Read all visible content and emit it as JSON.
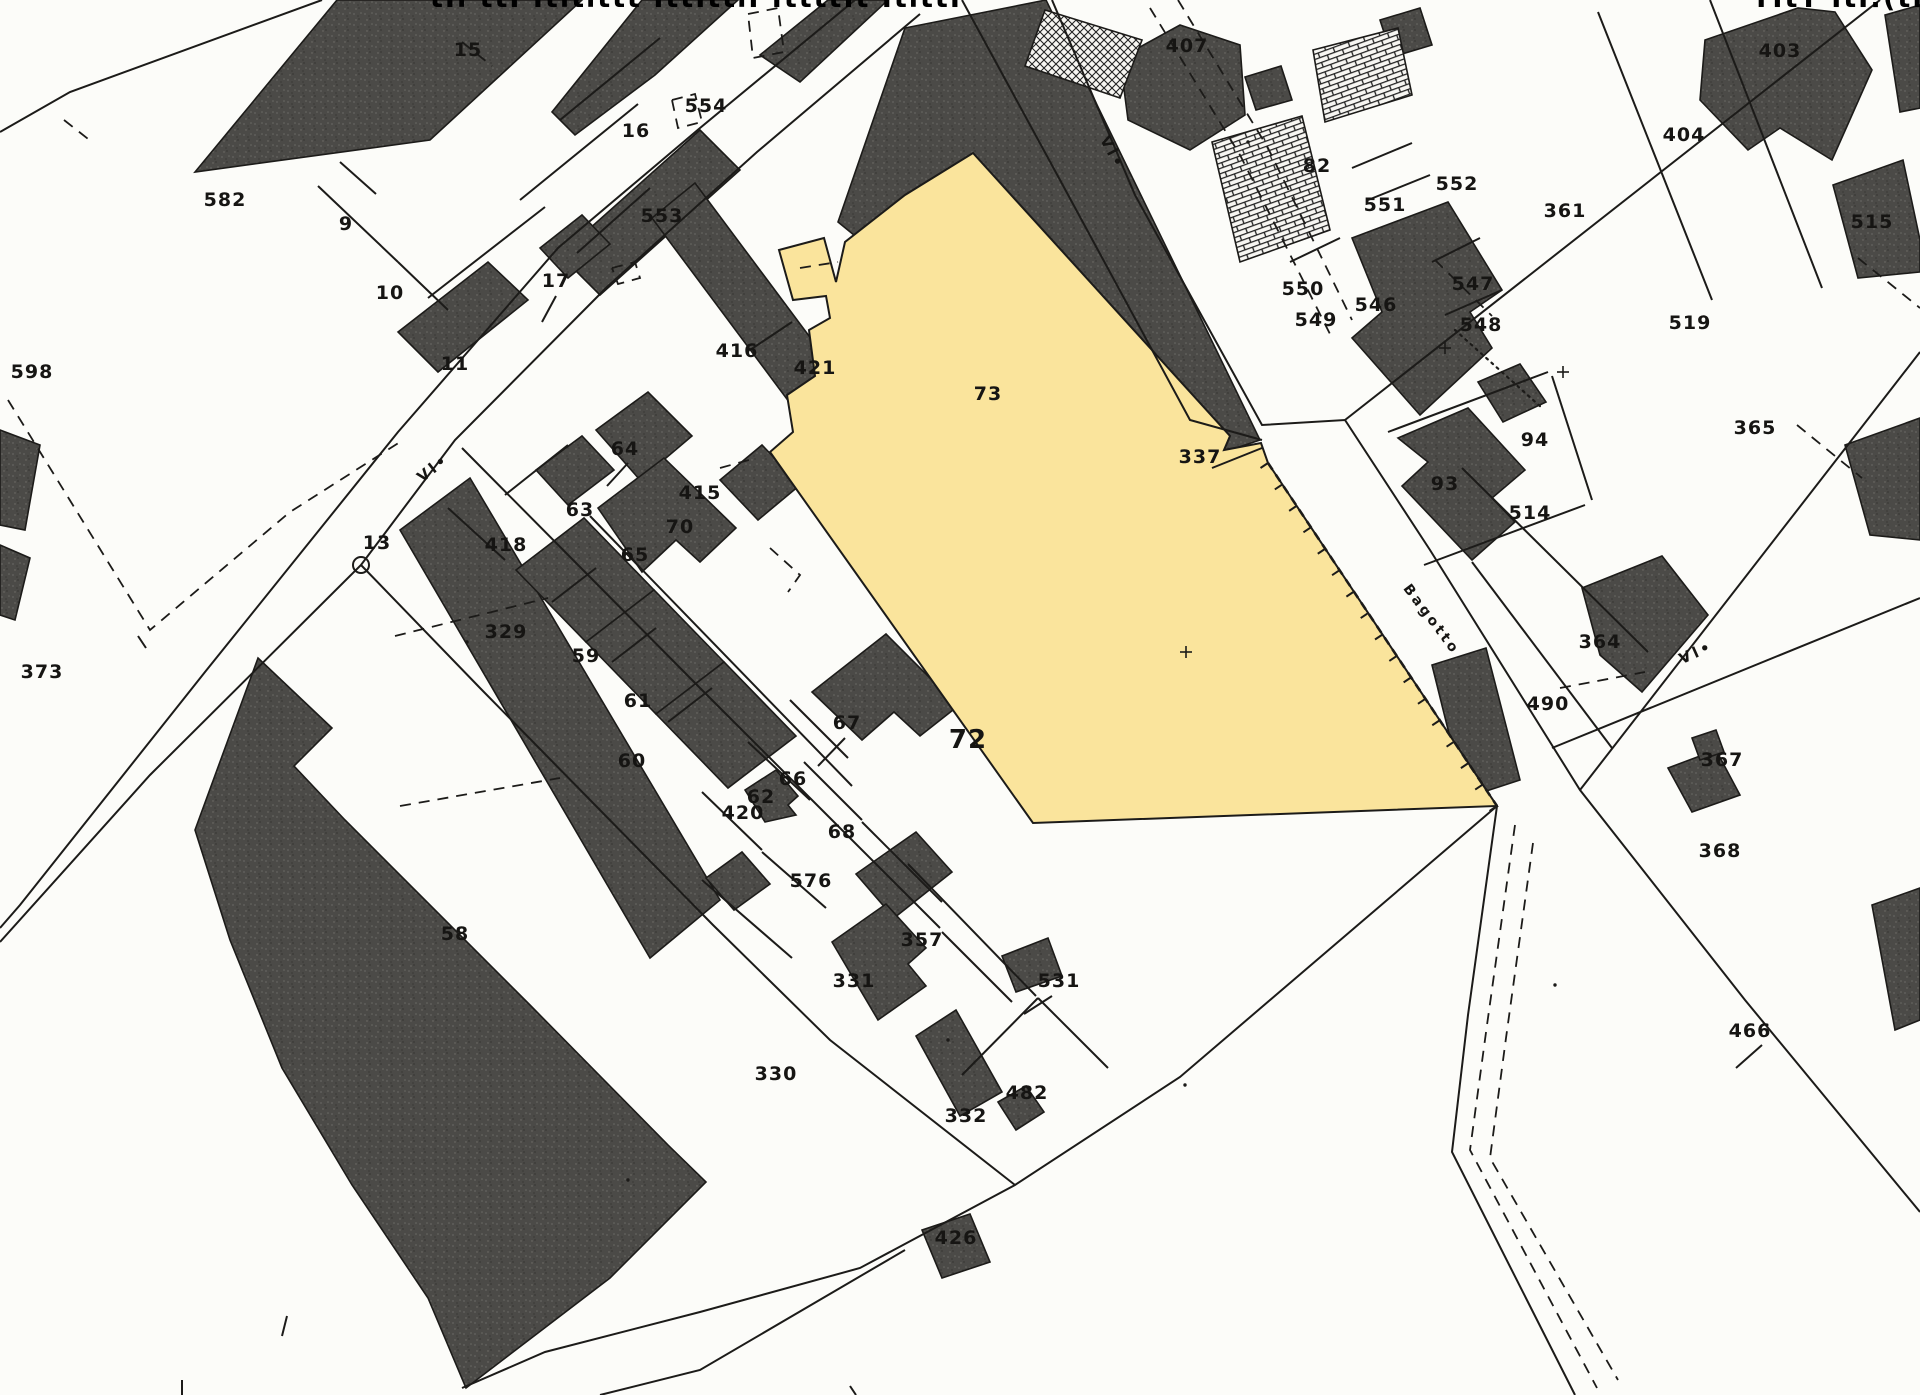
{
  "map": {
    "type": "cadastral-parcel-map",
    "background_color": "#fcfcf9",
    "line_color": "#1c1b19",
    "building_fill": "#4b4a47",
    "highlight": {
      "parcel_number": "73",
      "fill_color": "#fae49c"
    },
    "top_strip": {
      "left_fragment": "tIl ttI Itltlttt   IttIttlI IttttIt ItlttI",
      "right_fragment": "TItT ItI:(tIII It"
    },
    "street_labels": [
      {
        "text": "Vl•",
        "x": 436,
        "y": 472,
        "rot": -38,
        "size": 15
      },
      {
        "text": "Vl•",
        "x": 1108,
        "y": 155,
        "rot": 62,
        "size": 15
      },
      {
        "text": "Vl•",
        "x": 1698,
        "y": 657,
        "rot": -24,
        "size": 15
      },
      {
        "text": "Bagotto",
        "x": 1428,
        "y": 622,
        "rot": 53,
        "size": 14
      }
    ],
    "parcel_labels": [
      {
        "text": "582",
        "x": 225,
        "y": 206
      },
      {
        "text": "598",
        "x": 32,
        "y": 378
      },
      {
        "text": "15",
        "x": 468,
        "y": 56
      },
      {
        "text": "554",
        "x": 706,
        "y": 112
      },
      {
        "text": "16",
        "x": 636,
        "y": 137
      },
      {
        "text": "553",
        "x": 662,
        "y": 222
      },
      {
        "text": "9",
        "x": 346,
        "y": 230
      },
      {
        "text": "10",
        "x": 390,
        "y": 299
      },
      {
        "text": "17",
        "x": 556,
        "y": 287
      },
      {
        "text": "11",
        "x": 455,
        "y": 370
      },
      {
        "text": "13",
        "x": 377,
        "y": 549
      },
      {
        "text": "373",
        "x": 42,
        "y": 678
      },
      {
        "text": "416",
        "x": 737,
        "y": 357
      },
      {
        "text": "421",
        "x": 815,
        "y": 374
      },
      {
        "text": "73",
        "x": 988,
        "y": 400
      },
      {
        "text": "64",
        "x": 625,
        "y": 455
      },
      {
        "text": "63",
        "x": 580,
        "y": 516
      },
      {
        "text": "415",
        "x": 700,
        "y": 499
      },
      {
        "text": "70",
        "x": 680,
        "y": 533
      },
      {
        "text": "65",
        "x": 635,
        "y": 561
      },
      {
        "text": "418",
        "x": 506,
        "y": 551
      },
      {
        "text": "329",
        "x": 506,
        "y": 638
      },
      {
        "text": "59",
        "x": 586,
        "y": 662
      },
      {
        "text": "61",
        "x": 638,
        "y": 707
      },
      {
        "text": "60",
        "x": 632,
        "y": 767
      },
      {
        "text": "62",
        "x": 761,
        "y": 803
      },
      {
        "text": "420",
        "x": 743,
        "y": 819
      },
      {
        "text": "66",
        "x": 793,
        "y": 785
      },
      {
        "text": "67",
        "x": 847,
        "y": 729
      },
      {
        "text": "68",
        "x": 842,
        "y": 838
      },
      {
        "text": "576",
        "x": 811,
        "y": 887
      },
      {
        "text": "72",
        "x": 968,
        "y": 748,
        "size": 26
      },
      {
        "text": "58",
        "x": 455,
        "y": 940
      },
      {
        "text": "330",
        "x": 776,
        "y": 1080
      },
      {
        "text": "357",
        "x": 922,
        "y": 946
      },
      {
        "text": "331",
        "x": 854,
        "y": 987
      },
      {
        "text": "531",
        "x": 1059,
        "y": 987
      },
      {
        "text": "332",
        "x": 966,
        "y": 1122
      },
      {
        "text": "482",
        "x": 1027,
        "y": 1099
      },
      {
        "text": "426",
        "x": 956,
        "y": 1244
      },
      {
        "text": "337",
        "x": 1200,
        "y": 463
      },
      {
        "text": "407",
        "x": 1187,
        "y": 52
      },
      {
        "text": "82",
        "x": 1317,
        "y": 172
      },
      {
        "text": "551",
        "x": 1385,
        "y": 211
      },
      {
        "text": "552",
        "x": 1457,
        "y": 190
      },
      {
        "text": "550",
        "x": 1303,
        "y": 295
      },
      {
        "text": "549",
        "x": 1316,
        "y": 326
      },
      {
        "text": "546",
        "x": 1376,
        "y": 311
      },
      {
        "text": "547",
        "x": 1473,
        "y": 290
      },
      {
        "text": "548",
        "x": 1481,
        "y": 331
      },
      {
        "text": "361",
        "x": 1565,
        "y": 217
      },
      {
        "text": "404",
        "x": 1684,
        "y": 141
      },
      {
        "text": "403",
        "x": 1780,
        "y": 57
      },
      {
        "text": "515",
        "x": 1872,
        "y": 228
      },
      {
        "text": "519",
        "x": 1690,
        "y": 329
      },
      {
        "text": "365",
        "x": 1755,
        "y": 434
      },
      {
        "text": "93",
        "x": 1445,
        "y": 490
      },
      {
        "text": "94",
        "x": 1535,
        "y": 446
      },
      {
        "text": "514",
        "x": 1530,
        "y": 519
      },
      {
        "text": "364",
        "x": 1600,
        "y": 648
      },
      {
        "text": "490",
        "x": 1548,
        "y": 710
      },
      {
        "text": "367",
        "x": 1722,
        "y": 766
      },
      {
        "text": "368",
        "x": 1720,
        "y": 857
      },
      {
        "text": "466",
        "x": 1750,
        "y": 1037
      }
    ],
    "markers": [
      {
        "name": "survey-circle",
        "x": 361,
        "y": 565,
        "label": "13"
      }
    ]
  }
}
